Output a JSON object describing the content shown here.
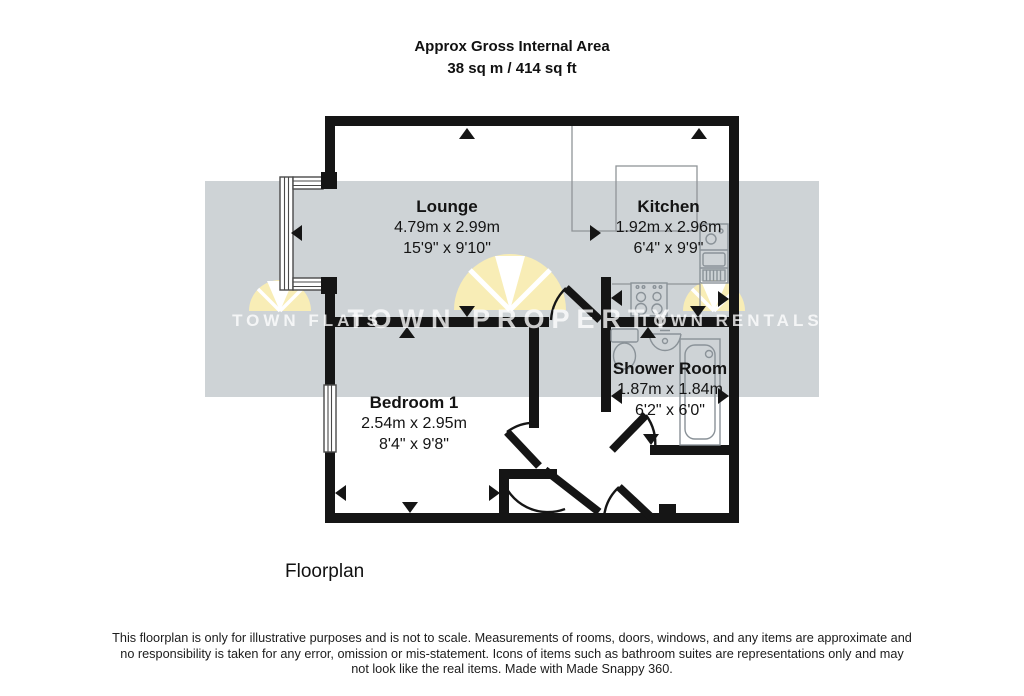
{
  "title": {
    "line1": "Approx Gross Internal Area",
    "line2": "38 sq m / 414 sq ft"
  },
  "rooms": {
    "lounge": {
      "name": "Lounge",
      "metric": "4.79m x 2.99m",
      "imperial": "15'9\" x 9'10\""
    },
    "kitchen": {
      "name": "Kitchen",
      "metric": "1.92m x 2.96m",
      "imperial": "6'4\" x 9'9\""
    },
    "bedroom1": {
      "name": "Bedroom 1",
      "metric": "2.54m x 2.95m",
      "imperial": "8'4\" x 9'8\""
    },
    "shower_room": {
      "name": "Shower Room",
      "metric": "1.87m x 1.84m",
      "imperial": "6'2\" x 6'0\""
    }
  },
  "watermarks": {
    "left": "TOWN FLATS",
    "center": "TOWN PROPERTY",
    "right": "TOWN RENTALS"
  },
  "caption": "Floorplan",
  "disclaimer": "This floorplan is only for illustrative purposes and is not to scale. Measurements of rooms, doors, windows, and any items are approximate and no responsibility is taken for any error, omission or mis-statement. Icons of items such as bathroom suites are representations only and may not look like the real items. Made with Made Snappy 360.",
  "colors": {
    "wall": "#151515",
    "watermark_band": "#ced3d6",
    "logo_yellow": "#f8edb6",
    "fixture_line": "#8a9298"
  }
}
